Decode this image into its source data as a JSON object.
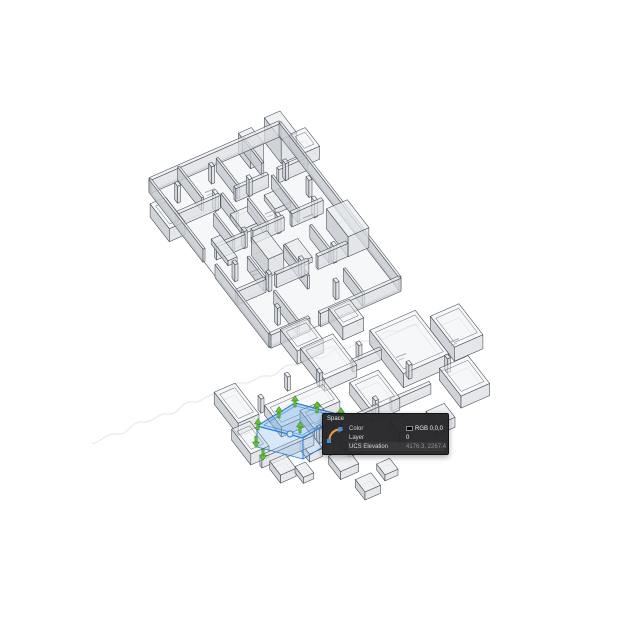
{
  "app": {
    "background": "#ffffff"
  },
  "tooltip": {
    "title": "Space",
    "icon": "polyline-arc-icon",
    "rows": [
      {
        "label": "Color",
        "value": "RGB 0,0,0",
        "swatch": "#000000"
      },
      {
        "label": "Layer",
        "value": "0"
      },
      {
        "label": "UCS Elevation",
        "value": "4176.3, 2267.4",
        "muted": true
      }
    ]
  },
  "selection": {
    "object": "space-object",
    "outline": "#2a7fd0",
    "fill_top": "rgba(120,178,235,0.45)",
    "fill_side_left": "rgba(125,180,235,0.30)",
    "fill_side_front": "rgba(135,188,240,0.22)",
    "box_top": [
      [
        257,
        426
      ],
      [
        295,
        403
      ],
      [
        341,
        415
      ],
      [
        303,
        438
      ]
    ],
    "depth": 21,
    "grip_fill": "#62c238",
    "grip_stroke": "#2e7c12",
    "grips_up": [
      [
        295,
        401
      ],
      [
        317,
        407
      ],
      [
        341,
        413
      ],
      [
        279,
        412
      ],
      [
        258,
        424
      ],
      [
        300,
        427
      ]
    ],
    "grips_down": [
      [
        256,
        442
      ],
      [
        263,
        455
      ]
    ],
    "circle_grip": [
      290,
      434
    ]
  },
  "drawing": {
    "colors": {
      "line": "#454a52",
      "top": "rgba(233,235,238,0.72)",
      "side_dark": "rgba(198,202,208,0.82)",
      "side_light": "rgba(219,222,226,0.72)",
      "floor": "rgba(239,240,243,0.55)",
      "mark": "#9aa0a6"
    },
    "watermark": {
      "color": "#dadada",
      "path": "M92,444 c10,-3 16,-12 26,-10 c10,2 14,-14 24,-12 c10,2 16,-10 26,-8 c10,2 14,-14 24,-12 c10,2 16,-10 26,-8 c10,2 14,-13 24,-11 c10,2 16,-9 26,-7 c10,2 14,-13 24,-11 c10,2 16,-9 26,-7 c10,2 14,-12 24,-10 c10,2 16,-9 26,-7 c10,2 14,-12 24,-10 c10,2 16,-8 26,-6"
    },
    "clusters": [
      {
        "name": "upper-floor-plan",
        "o": [
          150,
          192
        ],
        "u": [
          130,
          -57
        ],
        "v": [
          120,
          155
        ],
        "wall_h": 13,
        "wall_t": 0.016,
        "col_h": 17,
        "col_s": 0.024,
        "floor": [
          0,
          0,
          1,
          1
        ],
        "walls": [
          [
            0,
            0,
            1,
            0
          ],
          [
            0,
            1,
            0.3,
            1
          ],
          [
            0.38,
            1,
            1,
            1
          ],
          [
            0,
            0,
            0,
            0.45
          ],
          [
            0,
            0.55,
            0,
            1
          ],
          [
            1,
            0,
            1,
            1
          ],
          [
            0,
            0.22,
            0.33,
            0.22
          ],
          [
            0.45,
            0.22,
            0.7,
            0.22
          ],
          [
            0.78,
            0.22,
            1,
            0.22
          ],
          [
            0.08,
            0.46,
            0.3,
            0.46
          ],
          [
            0.36,
            0.46,
            0.6,
            0.46
          ],
          [
            0.66,
            0.46,
            0.9,
            0.46
          ],
          [
            0,
            0.72,
            0.22,
            0.72
          ],
          [
            0.3,
            0.72,
            0.55,
            0.72
          ],
          [
            0.62,
            0.72,
            0.85,
            0.72
          ],
          [
            0.22,
            0,
            0.22,
            0.2
          ],
          [
            0.22,
            0.3,
            0.22,
            0.46
          ],
          [
            0.22,
            0.58,
            0.22,
            0.72
          ],
          [
            0.22,
            0.8,
            0.22,
            1
          ],
          [
            0.48,
            0.04,
            0.48,
            0.22
          ],
          [
            0.48,
            0.3,
            0.48,
            0.46
          ],
          [
            0.48,
            0.6,
            0.48,
            0.8
          ],
          [
            0.72,
            0,
            0.72,
            0.16
          ],
          [
            0.72,
            0.24,
            0.72,
            0.46
          ],
          [
            0.72,
            0.56,
            0.72,
            0.72
          ],
          [
            0.72,
            0.84,
            0.72,
            1
          ],
          [
            0.35,
            0.22,
            0.35,
            0.35
          ]
        ],
        "rooms": [
          [
            0.08,
            1.0,
            0.2,
            0.14,
            13
          ],
          [
            0.45,
            1.0,
            0.16,
            0.12,
            13
          ],
          [
            1.0,
            0.08,
            0.12,
            0.12,
            13
          ],
          [
            -0.11,
            0.12,
            0.12,
            0.16,
            13
          ]
        ],
        "solids": [
          [
            0.85,
            0.55,
            0.16,
            0.18,
            20
          ],
          [
            0.88,
            0.0,
            0.12,
            0.14,
            24
          ],
          [
            0.68,
            0.0,
            0.1,
            0.1,
            20
          ],
          [
            0.3,
            0.52,
            0.12,
            0.14,
            18
          ],
          [
            0.34,
            0.3,
            0.14,
            0.1,
            5
          ],
          [
            0.52,
            0.56,
            0.1,
            0.12,
            5
          ],
          [
            0.12,
            0.38,
            0.07,
            0.14,
            5
          ],
          [
            0.62,
            0.28,
            0.12,
            0.09,
            5
          ]
        ],
        "cols": [
          [
            0.12,
            0.1
          ],
          [
            0.3,
            0.22
          ],
          [
            0.56,
            0.22
          ],
          [
            0.84,
            0.22
          ],
          [
            0.3,
            0.46
          ],
          [
            0.56,
            0.46
          ],
          [
            0.84,
            0.46
          ],
          [
            0.25,
            0.72
          ],
          [
            0.5,
            0.72
          ],
          [
            0.75,
            0.72
          ],
          [
            0.1,
            0.6
          ],
          [
            0.9,
            0.35
          ],
          [
            0.4,
            0.08
          ],
          [
            0.6,
            0.9
          ],
          [
            0.15,
            0.9
          ]
        ],
        "marks": [
          [
            0.35,
            0.12
          ],
          [
            0.6,
            0.35
          ],
          [
            0.25,
            0.6
          ],
          [
            0.55,
            0.65
          ],
          [
            0.8,
            0.45
          ]
        ]
      },
      {
        "name": "lower-floor-plan",
        "o": [
          216,
          420
        ],
        "u": [
          130,
          -57
        ],
        "v": [
          120,
          155
        ],
        "wall_h": 10,
        "wall_t": 0.016,
        "col_h": 14,
        "col_s": 0.024,
        "floor": null,
        "walls": [
          [
            0.05,
            0.32,
            0.45,
            0.32
          ],
          [
            0.55,
            0.32,
            0.95,
            0.32
          ],
          [
            1.05,
            0.32,
            1.35,
            0.32
          ],
          [
            1.0,
            0.05,
            1.22,
            0.05
          ]
        ],
        "rooms": [
          [
            0.06,
            -0.08,
            0.16,
            0.2,
            12
          ],
          [
            0.0,
            0.13,
            0.14,
            0.16,
            11
          ],
          [
            0.75,
            -0.11,
            0.25,
            0.2,
            12
          ],
          [
            1.22,
            -0.04,
            0.35,
            0.28,
            14
          ],
          [
            1.63,
            0.02,
            0.22,
            0.2,
            14
          ],
          [
            1.46,
            0.28,
            0.22,
            0.18,
            12
          ],
          [
            0.88,
            0.16,
            0.22,
            0.18,
            12
          ],
          [
            0.48,
            0.18,
            0.14,
            0.12,
            10
          ],
          [
            0.3,
            0.08,
            0.45,
            0.14,
            10
          ]
        ],
        "solids": [
          [
            0.09,
            0.35,
            0.12,
            0.09,
            8
          ],
          [
            0.35,
            0.32,
            0.1,
            0.08,
            8
          ],
          [
            0.6,
            0.38,
            0.12,
            0.08,
            8
          ],
          [
            0.95,
            0.42,
            0.1,
            0.08,
            10
          ],
          [
            1.2,
            0.45,
            0.14,
            0.09,
            10
          ],
          [
            0.22,
            0.42,
            0.08,
            0.07,
            6
          ],
          [
            0.45,
            0.45,
            0.14,
            0.1,
            8
          ],
          [
            0.5,
            0.62,
            0.12,
            0.08,
            8
          ],
          [
            0.7,
            0.58,
            0.1,
            0.07,
            6
          ]
        ],
        "cols": [
          [
            0.3,
            0.05
          ],
          [
            0.55,
            0.0
          ],
          [
            0.75,
            0.05
          ],
          [
            1.1,
            0.0
          ],
          [
            1.3,
            0.2
          ],
          [
            0.95,
            0.3
          ],
          [
            0.5,
            0.32
          ],
          [
            1.55,
            0.25
          ]
        ],
        "marks": [
          [
            1.35,
            0.08
          ],
          [
            1.72,
            0.12
          ],
          [
            1.0,
            0.26
          ],
          [
            0.62,
            0.26
          ]
        ]
      }
    ]
  }
}
